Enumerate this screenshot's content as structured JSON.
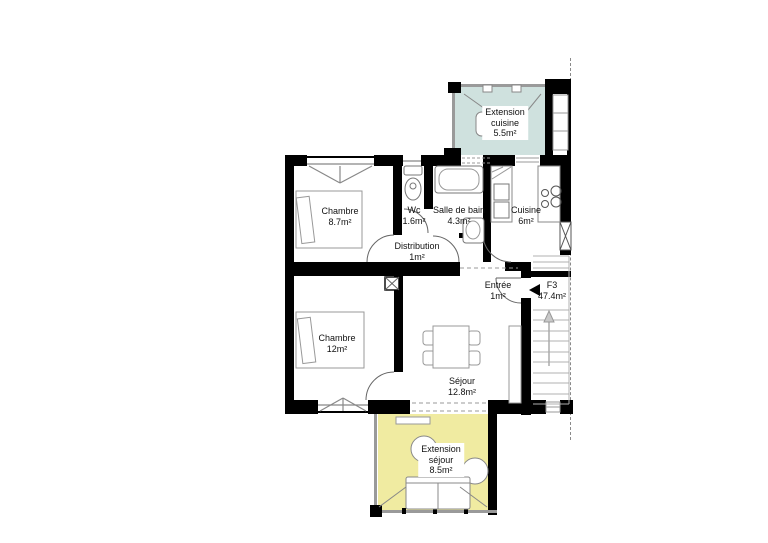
{
  "plan": {
    "type": "floor-plan",
    "unit": {
      "code": "F3",
      "area": "47.4m²"
    },
    "rooms": [
      {
        "id": "extension-cuisine",
        "name_lines": [
          "Extension",
          "cuisine"
        ],
        "area": "5.5m²"
      },
      {
        "id": "chambre-1",
        "name_lines": [
          "Chambre"
        ],
        "area": "8.7m²"
      },
      {
        "id": "wc",
        "name_lines": [
          "Wc"
        ],
        "area": "1.6m²"
      },
      {
        "id": "salle-de-bain",
        "name_lines": [
          "Salle de bain"
        ],
        "area": "4.3m²"
      },
      {
        "id": "cuisine",
        "name_lines": [
          "Cuisine"
        ],
        "area": "6m²"
      },
      {
        "id": "distribution",
        "name_lines": [
          "Distribution"
        ],
        "area": "1m²"
      },
      {
        "id": "entree",
        "name_lines": [
          "Entrée"
        ],
        "area": "1m²"
      },
      {
        "id": "chambre-2",
        "name_lines": [
          "Chambre"
        ],
        "area": "12m²"
      },
      {
        "id": "sejour",
        "name_lines": [
          "Séjour"
        ],
        "area": "12.8m²"
      },
      {
        "id": "extension-sejour",
        "name_lines": [
          "Extension",
          "séjour"
        ],
        "area": "8.5m²"
      }
    ],
    "colors": {
      "wall": "#000000",
      "extension_cuisine_fill": "#cfe1de",
      "extension_sejour_fill": "#f0eba1",
      "furniture_stroke": "#888888",
      "boundary_dash": "#8a8a8a"
    },
    "icons": {
      "entrance_arrow": "◀"
    }
  }
}
